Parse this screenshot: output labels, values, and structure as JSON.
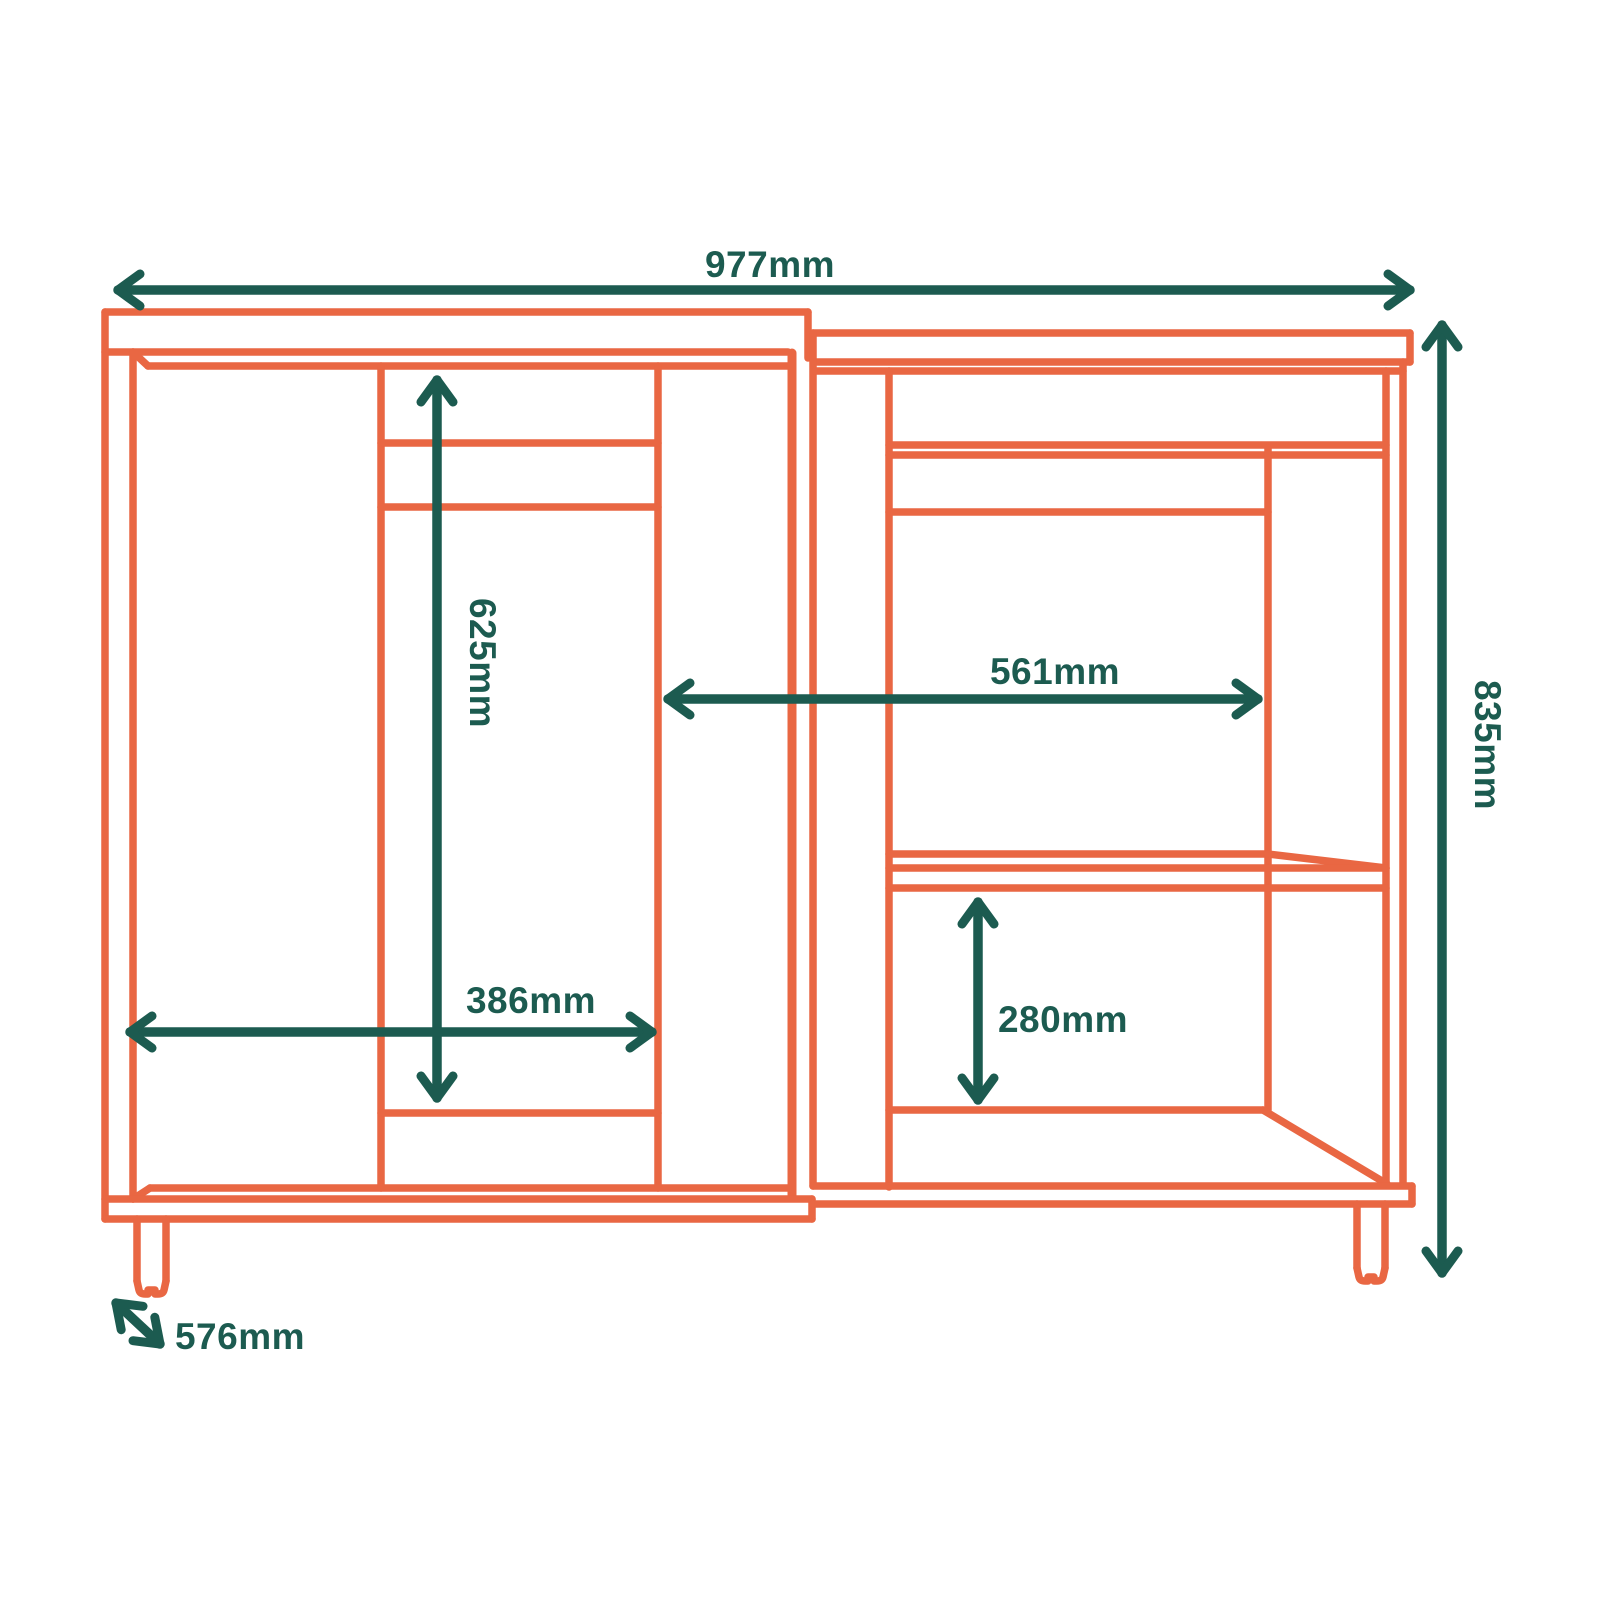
{
  "diagram": {
    "type": "furniture-dimension-diagram",
    "subject": "corner base cabinet with open compartments, drawer fronts, shelf and adjustable feet",
    "colors": {
      "outline_orange": "#E96743",
      "dimension_teal": "#1C5B50",
      "background": "#FFFFFF"
    },
    "dimensions": {
      "overall_width": {
        "label": "977mm",
        "orientation": "horizontal",
        "location": "top"
      },
      "overall_height": {
        "label": "835mm",
        "orientation": "vertical",
        "location": "right"
      },
      "left_compartment_height": {
        "label": "625mm",
        "orientation": "vertical",
        "location": "left-unit-interior"
      },
      "right_compartment_width": {
        "label": "561mm",
        "orientation": "horizontal",
        "location": "right-unit-interior"
      },
      "left_compartment_width": {
        "label": "386mm",
        "orientation": "horizontal",
        "location": "left-unit-interior"
      },
      "right_lower_compartment_height": {
        "label": "280mm",
        "orientation": "vertical",
        "location": "right-unit-below-shelf"
      },
      "depth": {
        "label": "576mm",
        "orientation": "diagonal",
        "location": "bottom-left"
      }
    }
  }
}
